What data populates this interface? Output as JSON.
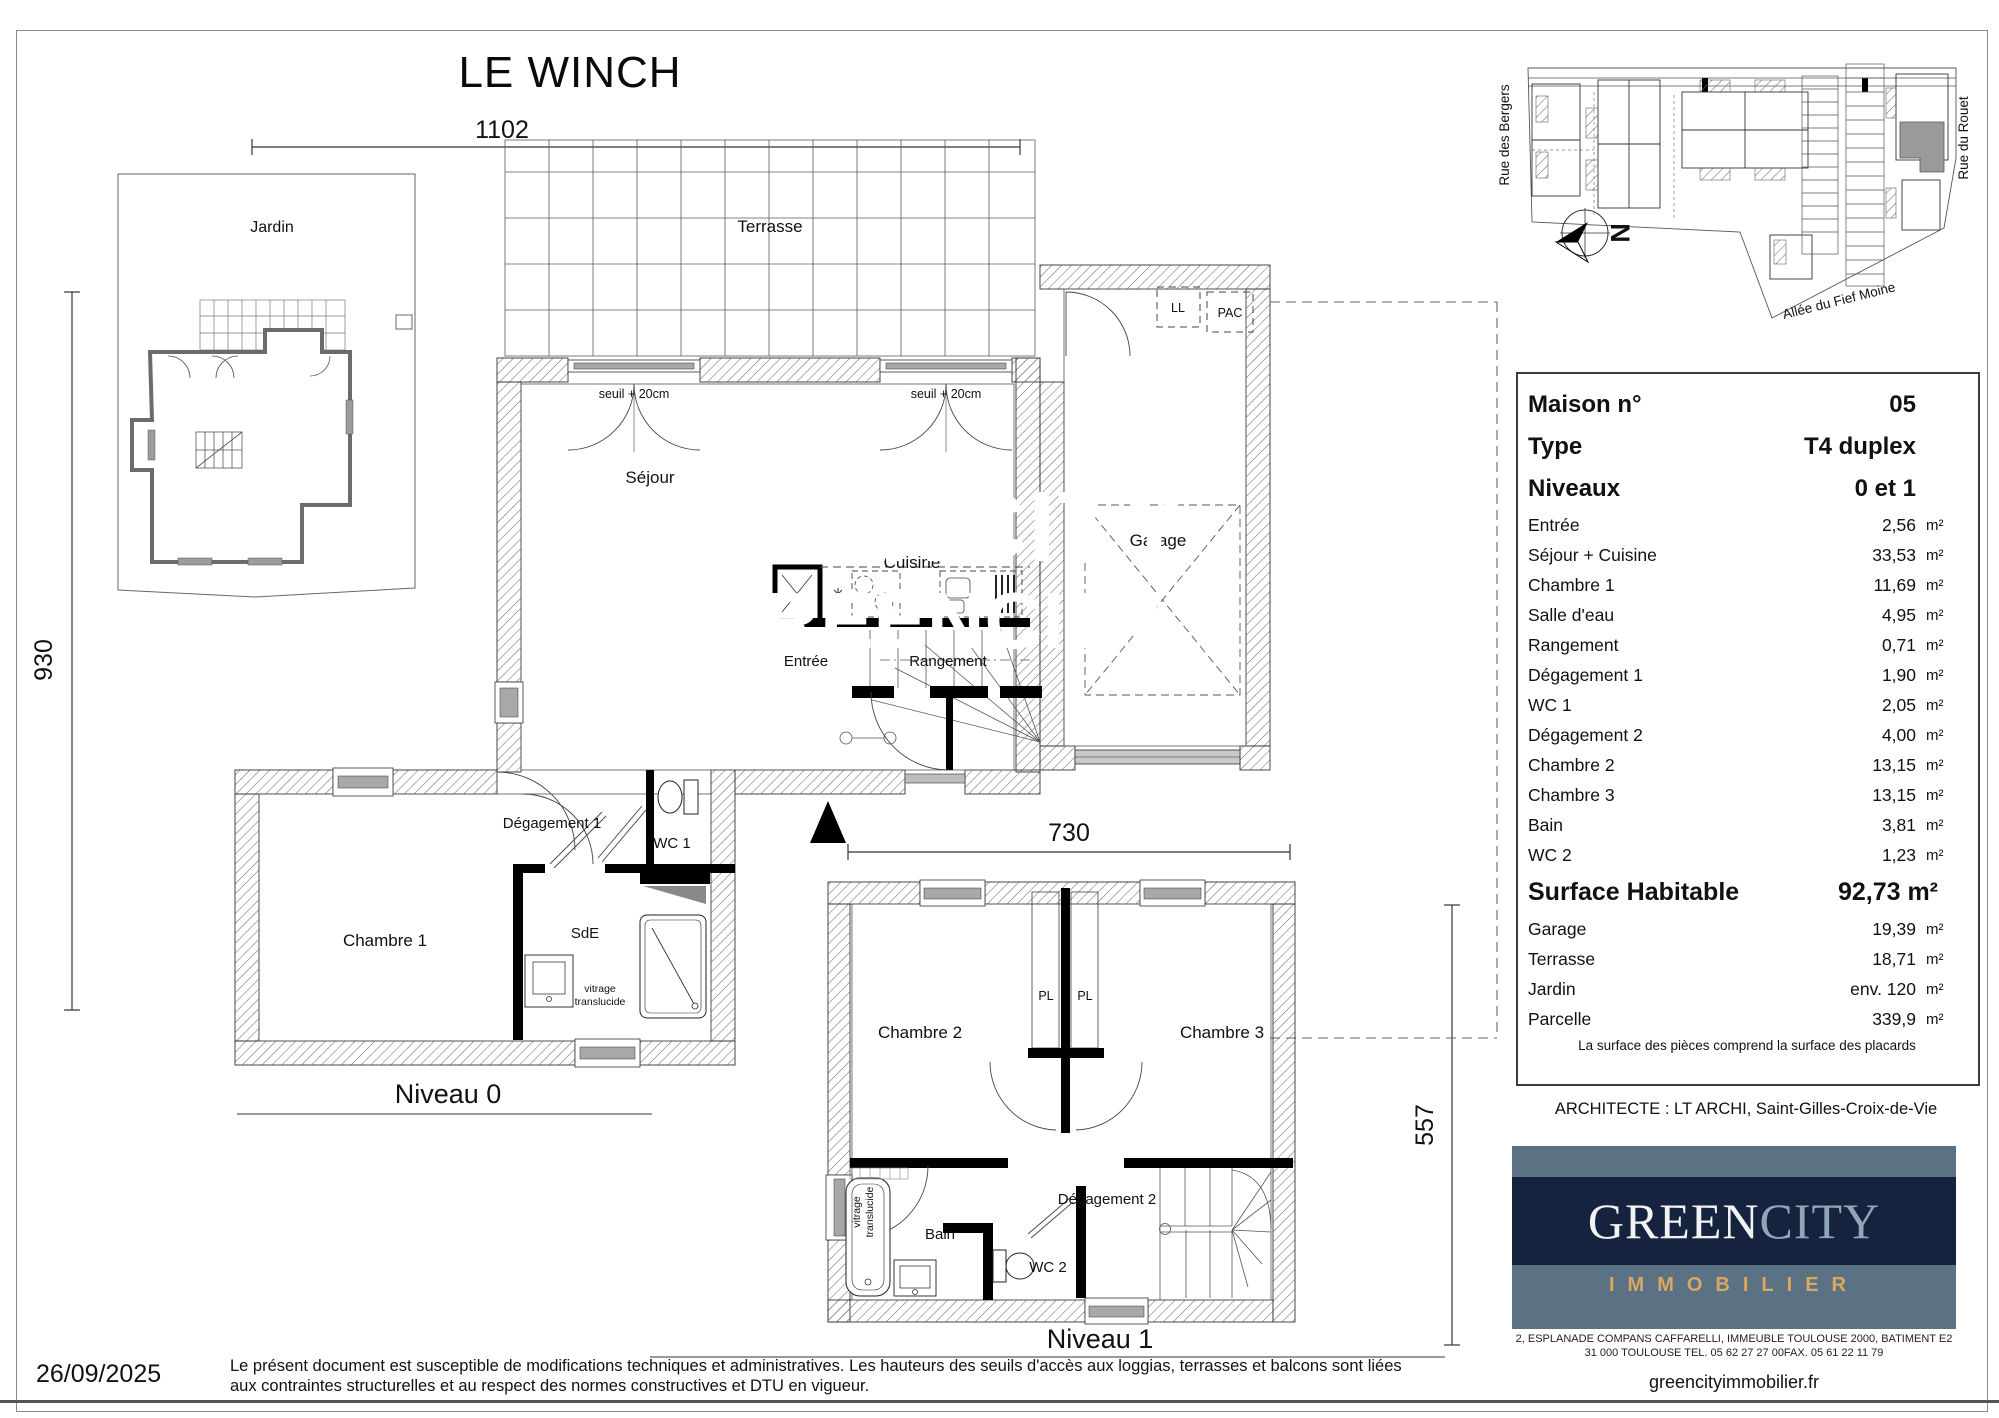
{
  "title": "LE WINCH",
  "dims": {
    "d1102": "1102",
    "d930": "930",
    "d730": "730",
    "d557": "557"
  },
  "plan0": {
    "label": "Niveau 0",
    "rooms": {
      "jardin": "Jardin",
      "terrasse": "Terrasse",
      "sejour": "Séjour",
      "cuisine": "Cuisine",
      "entree": "Entrée",
      "rangement": "Rangement",
      "garage": "Garage",
      "ll": "LL",
      "pac": "PAC",
      "degagement1": "Dégagement 1",
      "wc1": "WC 1",
      "sde": "SdE",
      "chambre1": "Chambre 1"
    },
    "notes": {
      "seuil1": "seuil + 20cm",
      "seuil2": "seuil + 20cm",
      "vitrage1": "vitrage",
      "vitrage2": "translucide"
    }
  },
  "plan1": {
    "label": "Niveau 1",
    "rooms": {
      "chambre2": "Chambre 2",
      "chambre3": "Chambre 3",
      "pl1": "PL",
      "pl2": "PL",
      "degagement2": "Dégagement 2",
      "bain": "Bain",
      "wc2": "WC 2"
    },
    "notes": {
      "vitrage1": "vitrage",
      "vitrage2": "translucide"
    }
  },
  "siteplan": {
    "street_left": "Rue des Bergers",
    "street_right": "Rue du Rouet",
    "street_bottom": "Allée du Fief Moine",
    "north": "N"
  },
  "info": {
    "header_rows": [
      {
        "label": "Maison n°",
        "value": "05"
      },
      {
        "label": "Type",
        "value": "T4 duplex"
      },
      {
        "label": "Niveaux",
        "value": "0 et 1"
      }
    ],
    "room_rows": [
      {
        "label": "Entrée",
        "value": "2,56",
        "unit": "m²"
      },
      {
        "label": "Séjour + Cuisine",
        "value": "33,53",
        "unit": "m²"
      },
      {
        "label": "Chambre 1",
        "value": "11,69",
        "unit": "m²"
      },
      {
        "label": "Salle d'eau",
        "value": "4,95",
        "unit": "m²"
      },
      {
        "label": "Rangement",
        "value": "0,71",
        "unit": "m²"
      },
      {
        "label": "Dégagement 1",
        "value": "1,90",
        "unit": "m²"
      },
      {
        "label": "WC 1",
        "value": "2,05",
        "unit": "m²"
      },
      {
        "label": "Dégagement 2",
        "value": "4,00",
        "unit": "m²"
      },
      {
        "label": "Chambre 2",
        "value": "13,15",
        "unit": "m²"
      },
      {
        "label": "Chambre 3",
        "value": "13,15",
        "unit": "m²"
      },
      {
        "label": "Bain",
        "value": "3,81",
        "unit": "m²"
      },
      {
        "label": "WC 2",
        "value": "1,23",
        "unit": "m²"
      }
    ],
    "surface_row": {
      "label": "Surface Habitable",
      "value": "92,73 m²"
    },
    "annex_rows": [
      {
        "label": "Garage",
        "value": "19,39",
        "unit": "m²"
      },
      {
        "label": "Terrasse",
        "value": "18,71",
        "unit": "m²"
      },
      {
        "label": "Jardin",
        "value": "env. 120",
        "unit": "m²"
      },
      {
        "label": "Parcelle",
        "value": "339,9",
        "unit": "m²"
      }
    ],
    "note": "La surface des pièces comprend la surface des placards",
    "architect": "ARCHITECTE : LT ARCHI, Saint-Gilles-Croix-de-Vie"
  },
  "logo": {
    "green": "GREEN",
    "city": "CITY",
    "sub": "IMMOBILIER",
    "watermark": "GREENCITY",
    "address1": "2, ESPLANADE COMPANS CAFFARELLI, IMMEUBLE TOULOUSE 2000, BATIMENT E2",
    "address2": "31 000 TOULOUSE TEL. 05 62 27 27 00FAX. 05 61 22 11 79",
    "website": "greencityimmobilier.fr",
    "colors": {
      "slate": "#5b7184",
      "navy": "#15233f",
      "green": "#f2f2f2",
      "city": "#8fa6b8",
      "gold": "#d9a85e"
    }
  },
  "footer": {
    "date": "26/09/2025",
    "disclaimer1": "Le présent document est susceptible de modifications techniques et administratives. Les hauteurs des seuils d'accès aux loggias, terrasses et balcons sont liées",
    "disclaimer2": "aux contraintes structurelles et au respect des normes constructives et DTU en vigueur."
  }
}
